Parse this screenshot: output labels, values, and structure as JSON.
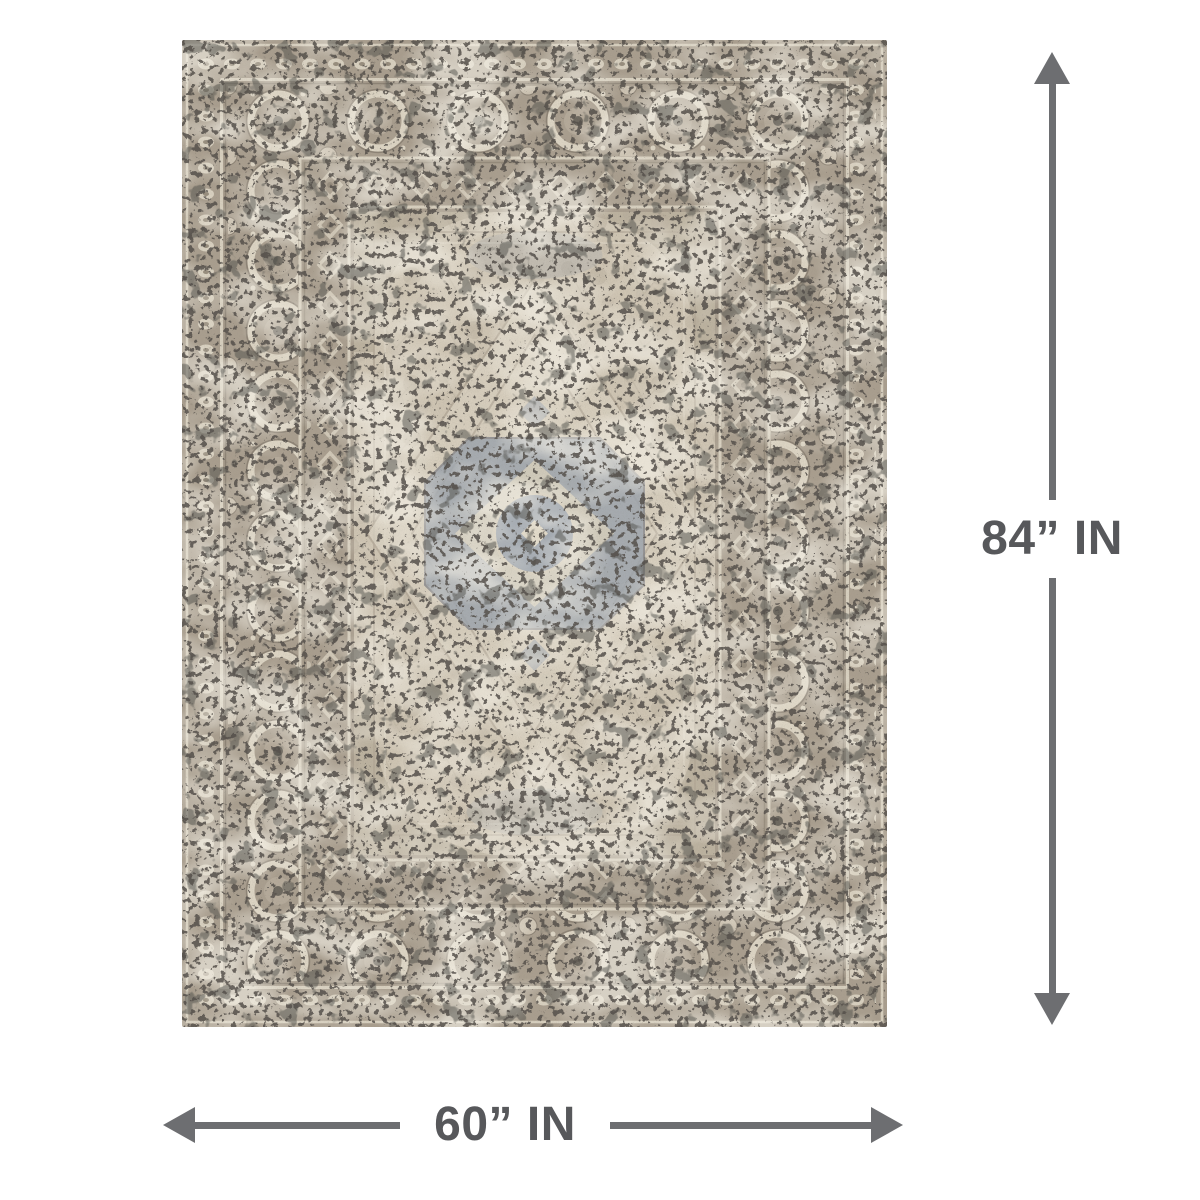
{
  "page": {
    "background": "#ffffff"
  },
  "annotations": {
    "height_label": "84” IN",
    "width_label": "60” IN"
  },
  "colors": {
    "arrow_color": "#6d6e71",
    "label_color": "#57585b",
    "rug_base": "#a99e8e",
    "rug_field": "#cfc5b3",
    "rug_ivory": "#d8d0bf",
    "rug_medallion": "#9ba3ad"
  }
}
